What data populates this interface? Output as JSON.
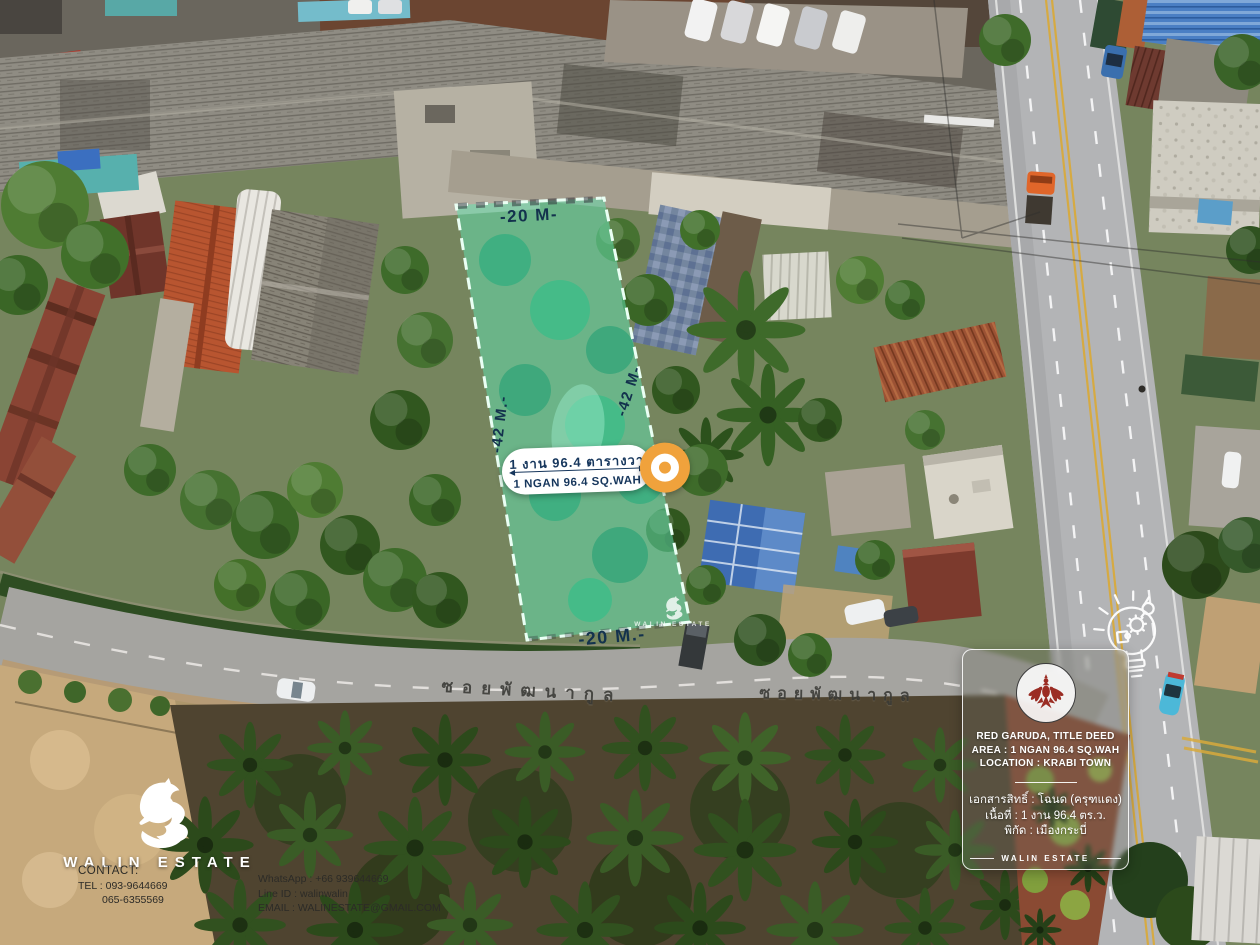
{
  "plot": {
    "top_width_label": "-20 M-",
    "bottom_width_label": "-20 M.-",
    "left_length_label": "-42 M.-",
    "right_length_label": "-42 M-",
    "area_thai": "1 งาน 96.4 ตารางวา",
    "area_english": "1 NGAN 96.4 SQ.WAH",
    "watermark": "WALIN ESTATE"
  },
  "road": {
    "name": "ซอยพัฒนากูล"
  },
  "card": {
    "line1": "RED GARUDA, TITLE DEED",
    "line2": "AREA : 1 NGAN 96.4 SQ.WAH",
    "line3": "LOCATION : KRABI TOWN",
    "thai1": "เอกสารสิทธิ์ : โฉนด (ครุฑแดง)",
    "thai2": "เนื้อที่ : 1 งาน 96.4 ตร.ว.",
    "thai3": "พิกัด : เมืองกระบี่",
    "footer": "WALIN ESTATE"
  },
  "brand": {
    "name": "WALIN ESTATE",
    "contact_label": "CONTACT:",
    "tel": "TEL : 093-9644669",
    "tel2": "065-6355569",
    "whatsapp": "WhatsApp : +66 939644669",
    "line_id": "Line ID : walinwalin",
    "email": "EMAIL : WALINESTATE@GMAIL.COM"
  },
  "colors": {
    "plot_overlay": "#57dfad",
    "accent_orange": "#f0a23c",
    "garuda_red": "#9b2d24",
    "dimension_navy": "#13324d"
  }
}
